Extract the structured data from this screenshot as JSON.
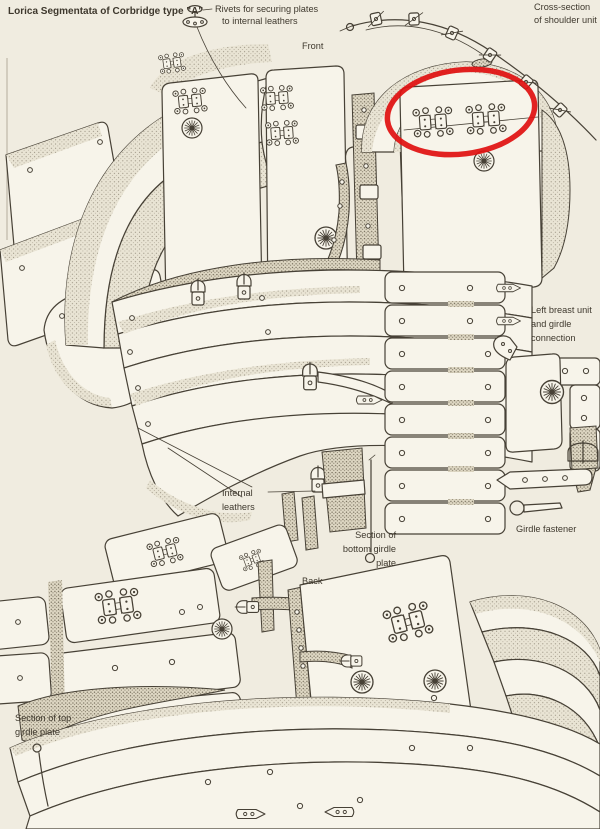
{
  "header": {
    "title": "Lorica Segmentata of Corbridge type \"A\""
  },
  "labels": {
    "front": "Front",
    "back": "Back",
    "rivets": {
      "line1": "Rivets for securing plates",
      "line2": "to internal leathers"
    },
    "cross_section": {
      "line1": "Cross-section",
      "line2": "of shoulder unit"
    },
    "left_breast": {
      "line1": "Left breast unit",
      "line2": "and girdle",
      "line3": "connection"
    },
    "girdle_fastener": "Girdle fastener",
    "internal_leathers": {
      "line1": "Internal",
      "line2": "leathers"
    },
    "section_bottom": {
      "line1": "Section of",
      "line2": "bottom girdle",
      "line3": "plate"
    },
    "section_top": {
      "line1": "Section of top",
      "line2": "girdle plate"
    }
  },
  "annotation": {
    "shape": "ellipse",
    "color": "#e01111"
  },
  "palette": {
    "paper": "#f0ece0",
    "plate": "#f7f4ea",
    "ink": "#474136",
    "stipple": "#8b8372"
  }
}
